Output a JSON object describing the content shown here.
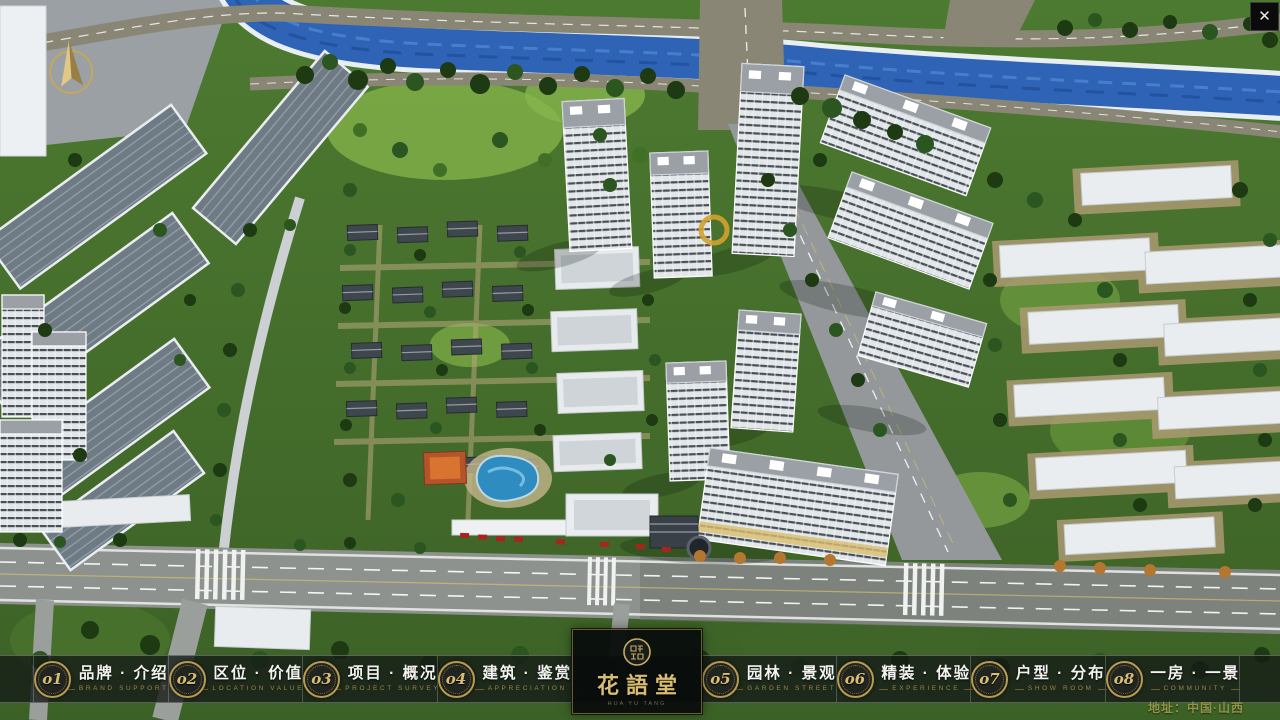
{
  "app": {
    "close_label": "✕",
    "address": "地址：中国·山西"
  },
  "logo": {
    "name": "花語堂",
    "tagline": "HUA YU TANG"
  },
  "nav": {
    "items": [
      {
        "num": "o1",
        "zh": "品牌 · 介绍",
        "en": "BRAND SUPPORT"
      },
      {
        "num": "o2",
        "zh": "区位 · 价值",
        "en": "LOCATION VALUE"
      },
      {
        "num": "o3",
        "zh": "项目 · 概况",
        "en": "PROJECT SURVEY"
      },
      {
        "num": "o4",
        "zh": "建筑 · 鉴赏",
        "en": "APPRECIATION"
      },
      {
        "num": "o5",
        "zh": "园林 · 景观",
        "en": "GARDEN STREET"
      },
      {
        "num": "o6",
        "zh": "精装 · 体验",
        "en": "EXPERIENCE"
      },
      {
        "num": "o7",
        "zh": "户型 · 分布",
        "en": "SHOW ROOM"
      },
      {
        "num": "o8",
        "zh": "一房 · 一景",
        "en": "COMMUNITY"
      }
    ]
  },
  "colors": {
    "accent_gold": "#C9A962",
    "bar_bg": "rgba(21,27,24,0.8)",
    "address_text": "#8F9447",
    "river": "#2E63B5",
    "road": "#8E928E",
    "vegetation": "#3F6529"
  }
}
